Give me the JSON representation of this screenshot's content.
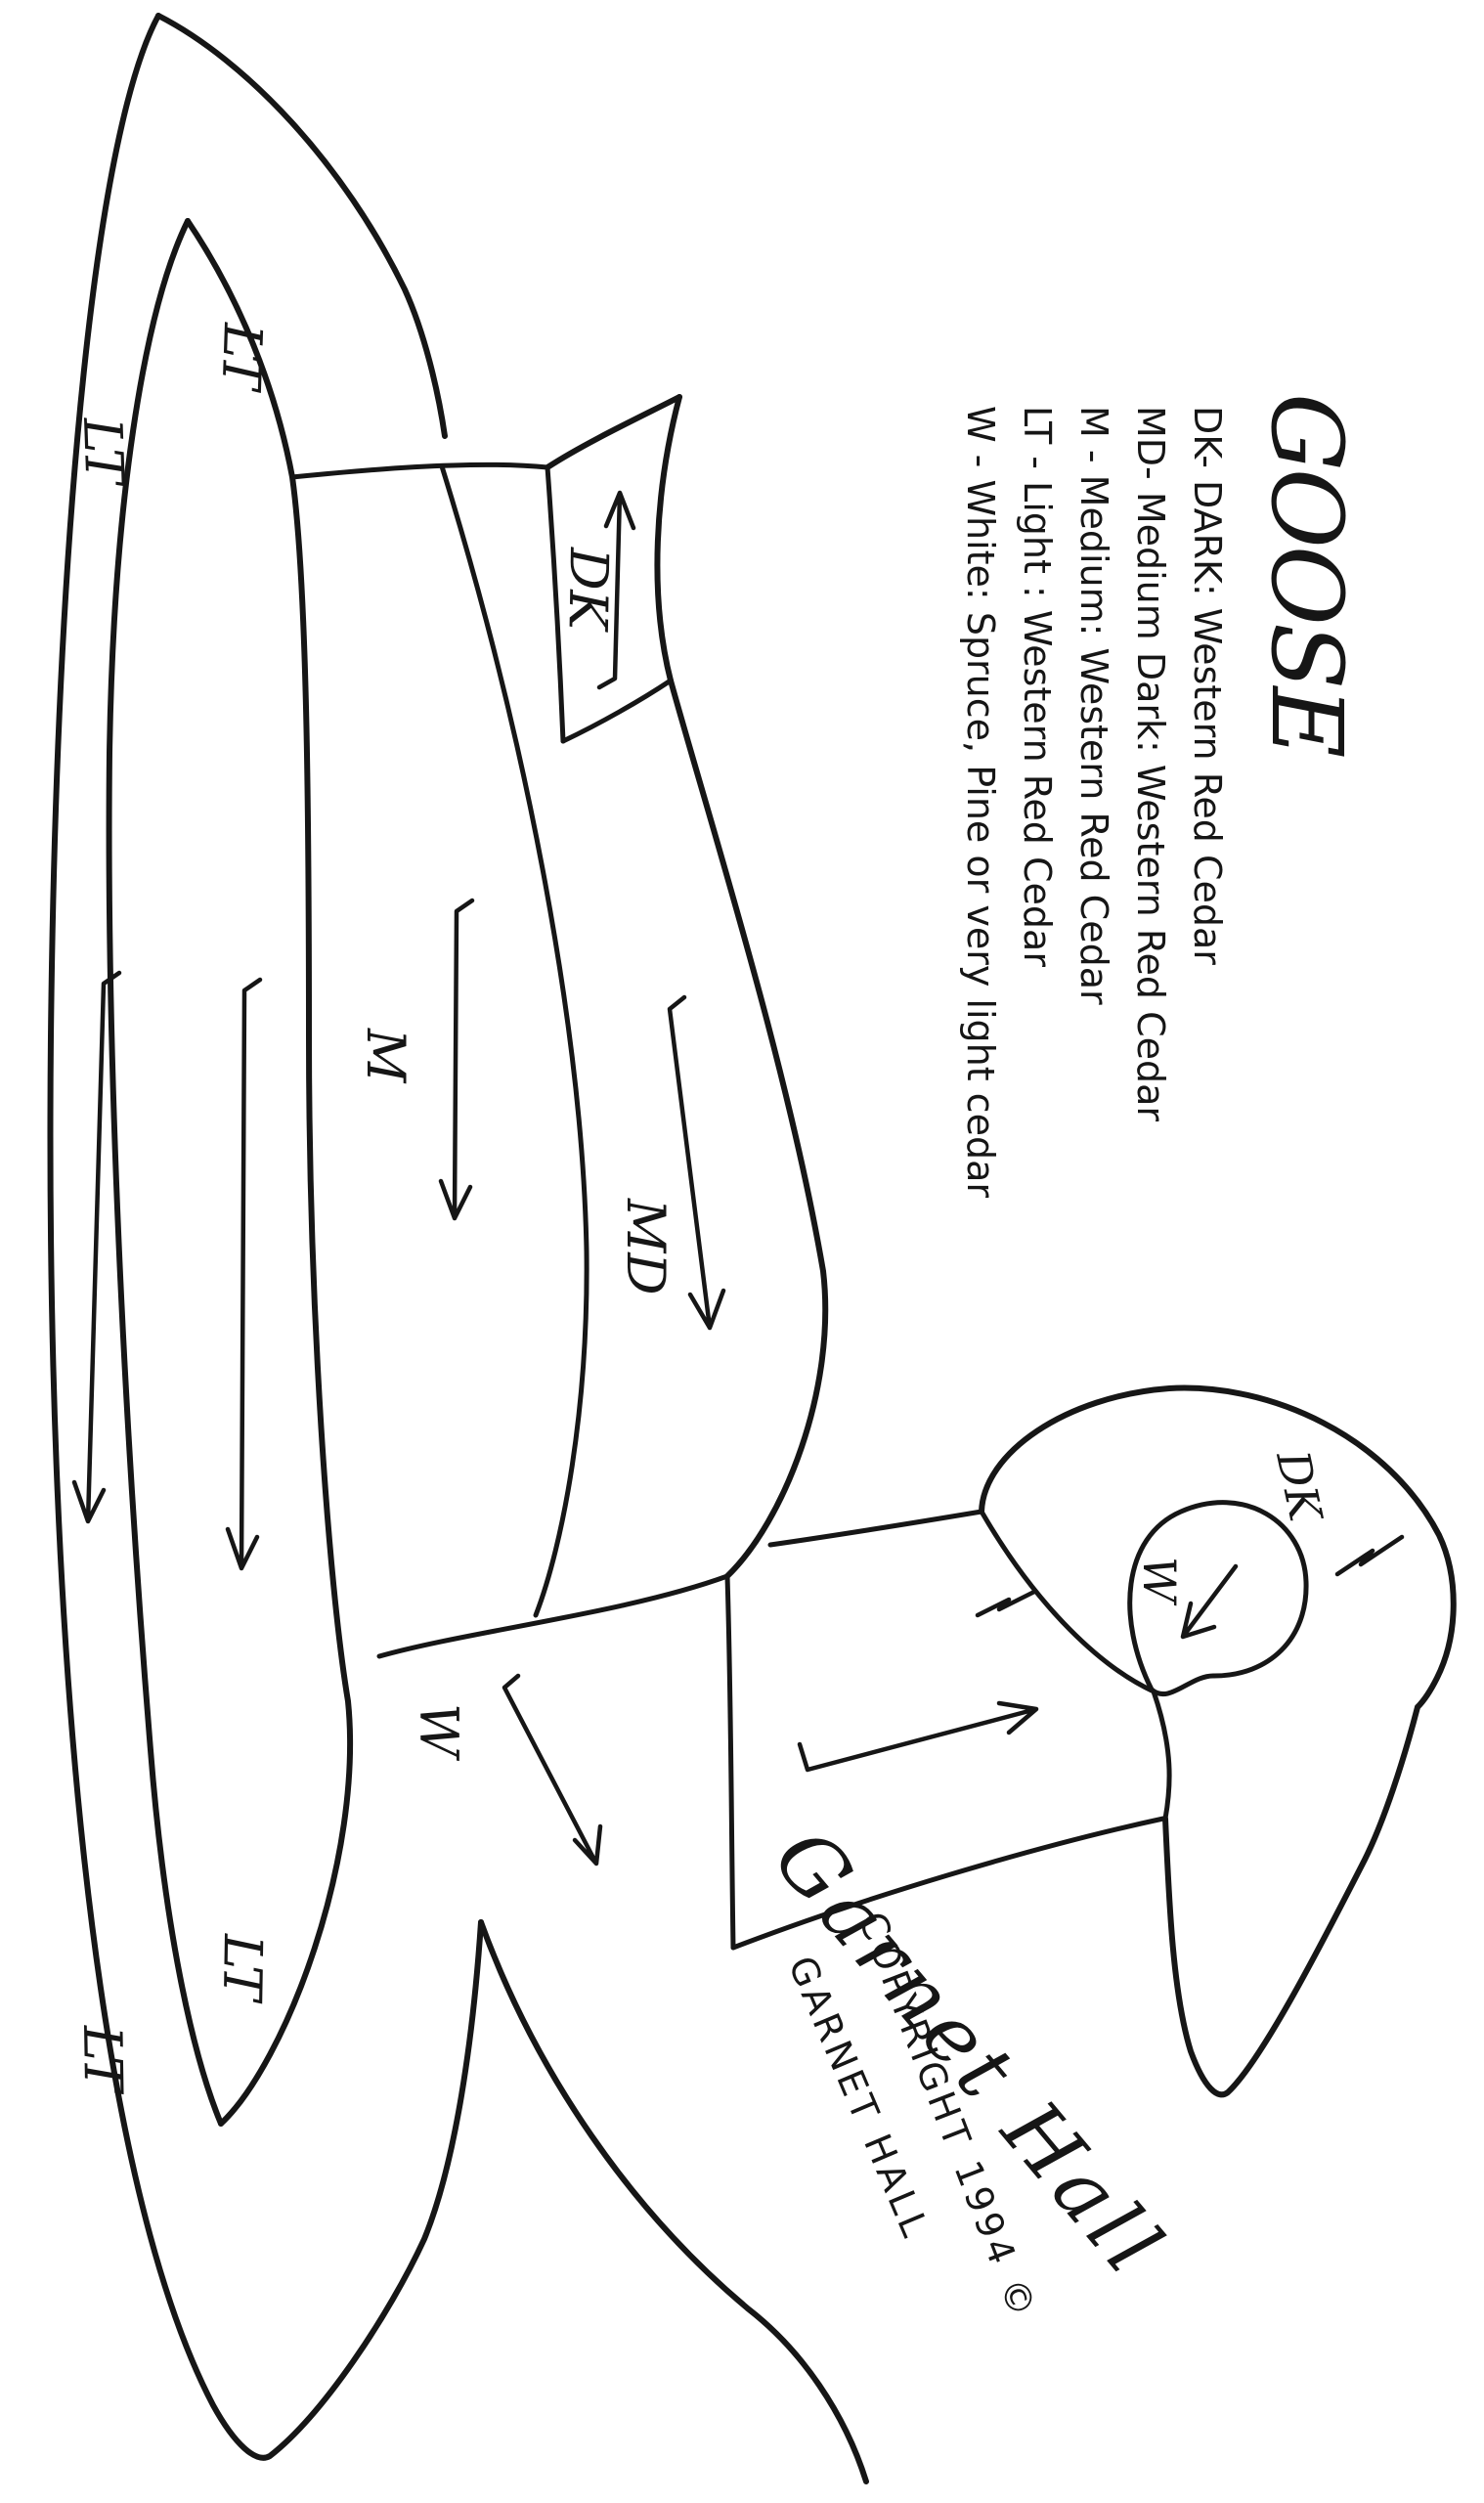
{
  "page": {
    "ink": "#161616",
    "paper": "#ffffff"
  },
  "title": "GOOSE",
  "legend": [
    {
      "code": "DK",
      "text": "DK- DARK: Western Red Cedar"
    },
    {
      "code": "MD",
      "text": "MD- Medium Dark: Western Red Cedar"
    },
    {
      "code": "M",
      "text": "M - Medium: Western Red Cedar"
    },
    {
      "code": "LT",
      "text": "LT - Light : Western Red Cedar"
    },
    {
      "code": "W",
      "text": "W - White: Spruce, Pine or very light cedar"
    }
  ],
  "region_labels": {
    "tail": "DK",
    "body": "M",
    "body_lower": "MD",
    "breast": "W",
    "wing_upper_1": "LT",
    "wing_upper_2": "LT",
    "wing_lower_1": "LT",
    "wing_lower_2": "LT",
    "head_dark": "DK",
    "cheek": "W"
  },
  "signature": {
    "script": "Garnet Hall",
    "copyright_line": "COPYRIGHT 1994 ©",
    "name_line": "GARNET HALL"
  }
}
